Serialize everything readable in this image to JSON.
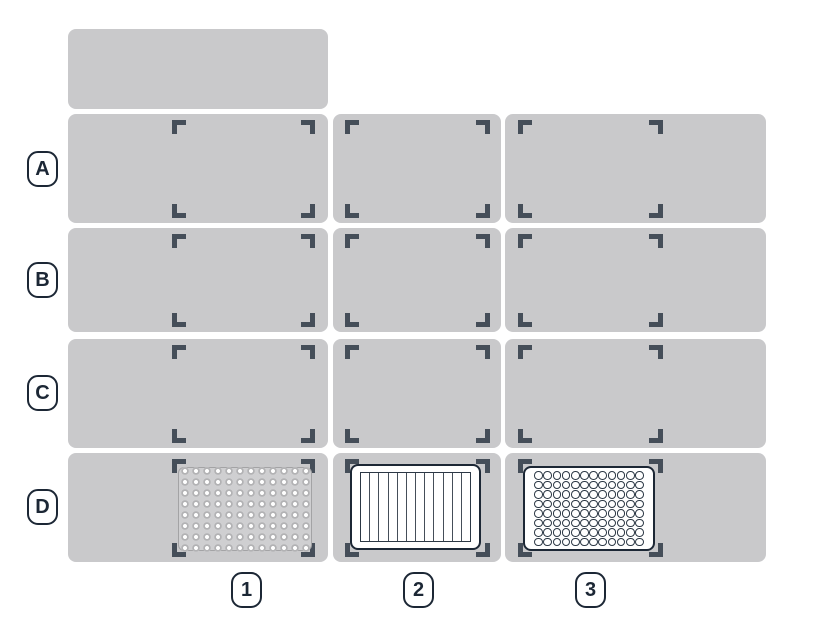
{
  "deck": {
    "name": "robot-deck-map",
    "row_labels": [
      "A",
      "B",
      "C",
      "D"
    ],
    "column_labels": [
      "1",
      "2",
      "3"
    ],
    "slots": [
      {
        "id": "A1",
        "occupied": false
      },
      {
        "id": "A2",
        "occupied": false
      },
      {
        "id": "A3",
        "occupied": false
      },
      {
        "id": "B1",
        "occupied": false
      },
      {
        "id": "B2",
        "occupied": false
      },
      {
        "id": "B3",
        "occupied": false
      },
      {
        "id": "C1",
        "occupied": false
      },
      {
        "id": "C2",
        "occupied": false
      },
      {
        "id": "C3",
        "occupied": false
      },
      {
        "id": "D1",
        "occupied": true
      },
      {
        "id": "D2",
        "occupied": true
      },
      {
        "id": "D3",
        "occupied": true
      }
    ]
  },
  "labware": {
    "d1": {
      "slot": "D1",
      "kind": "96-well plate (gray, round wells)",
      "columns": 12,
      "rows": 8
    },
    "d2": {
      "slot": "D2",
      "kind": "12-channel reservoir",
      "channels": 12
    },
    "d3": {
      "slot": "D3",
      "kind": "96-well plate (white, open wells)",
      "columns": 12,
      "rows": 8
    }
  },
  "colors": {
    "background": "#ffffff",
    "slot_fill": "#c9c9cb",
    "bracket": "#454e59",
    "outline": "#1c2735",
    "plate_gray": "#cfcfd1",
    "well_ring": "#b2b2b4"
  }
}
